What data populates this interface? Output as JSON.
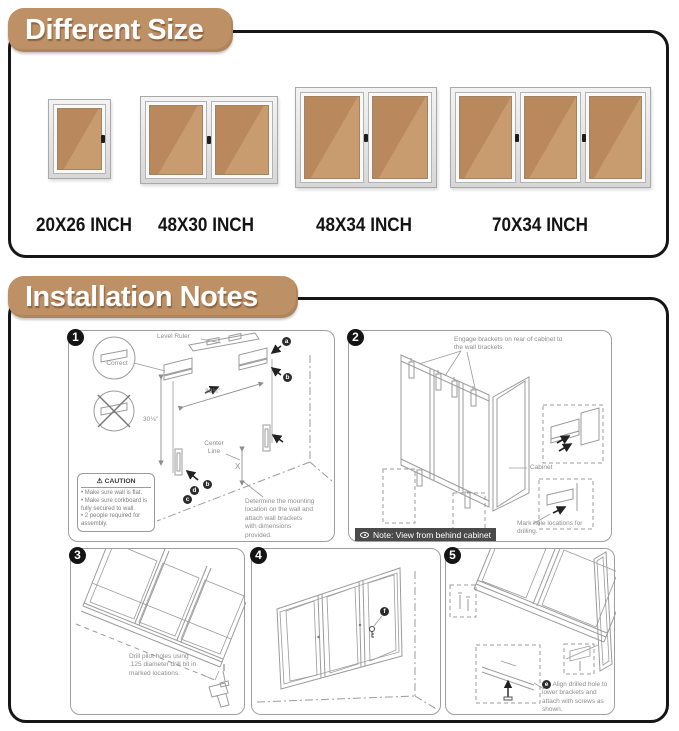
{
  "colors": {
    "pill_bg": "#bd9065",
    "cork_dark": "#b9895d",
    "cork_light": "#c99c70",
    "frame_silver": "#d8d8d8",
    "note_bar_bg": "#4a4a4a",
    "badge_bg": "#141414",
    "line_art": "#9b9b9b"
  },
  "size_section": {
    "title": "Different Size",
    "boards": [
      {
        "label": "20X26 INCH",
        "doors": 1
      },
      {
        "label": "48X30 INCH",
        "doors": 2
      },
      {
        "label": "48X34 INCH",
        "doors": 2
      },
      {
        "label": "70X34 INCH",
        "doors": 3
      }
    ]
  },
  "install_section": {
    "title": "Installation Notes",
    "steps": {
      "s1": {
        "number": "1",
        "level_ruler": "Level Ruler",
        "correct": "Correct",
        "dim_width": "39¾\"",
        "dim_height": "30⅛\"",
        "center_line": "Center Line",
        "x_label": "X",
        "caution_icon": "⚠",
        "caution_title": "CAUTION",
        "caution_items": [
          "Make sure wall is flat.",
          "Make sure corkboard is fully secured to wall.",
          "2 people required for assembly."
        ],
        "note": "Determine the mounting location on the wall and attach wall brackets with dimensions provided.",
        "letters_top": [
          "a",
          "b"
        ],
        "letters_bottom": [
          "d",
          "b",
          "c"
        ]
      },
      "s2": {
        "number": "2",
        "engage_label": "Engage brackets on rear of cabinet to the wall brackets.",
        "cabinet_label": "Cabinet",
        "mark_label": "Mark hole locations for drilling.",
        "note_bar": "Note: View from behind cabinet"
      },
      "s3": {
        "number": "3",
        "note": "Drill pilot holes using .125 diameter drill bit in marked locations."
      },
      "s4": {
        "number": "4",
        "letter": "f"
      },
      "s5": {
        "number": "5",
        "marker": "e",
        "note": "Align drilled hole to lower brackets and attach with screws as shown."
      }
    }
  }
}
